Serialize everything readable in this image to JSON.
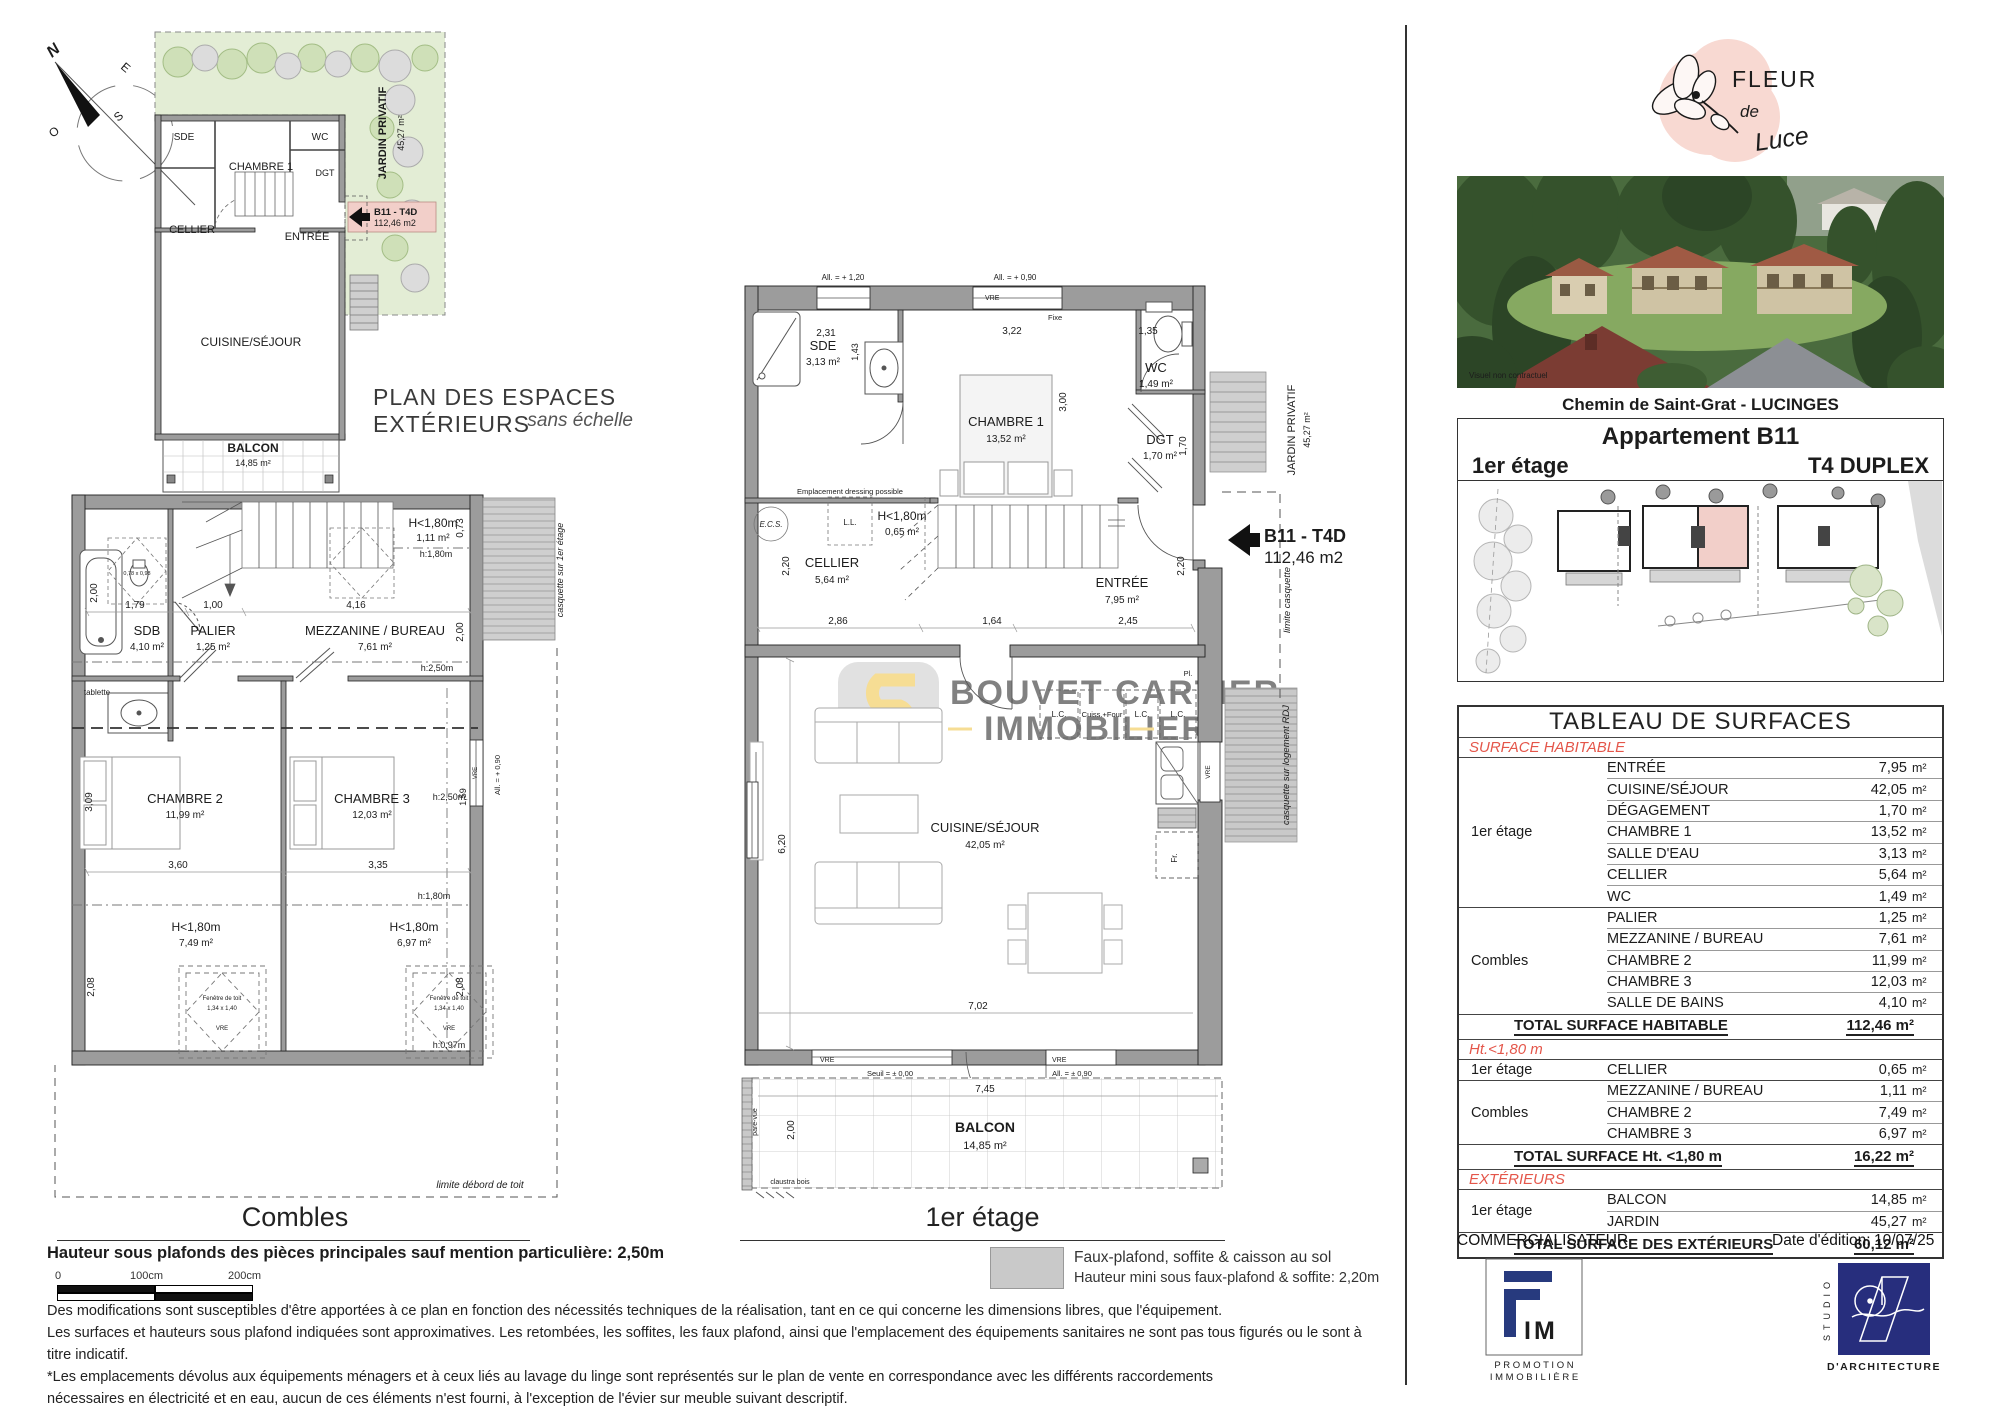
{
  "captions": {
    "mini_title": "PLAN DES ESPACES EXTÉRIEURS",
    "mini_sub": "sans échelle",
    "combles": "Combles",
    "etage": "1er étage"
  },
  "compass": {
    "n": "N",
    "e": "E",
    "s": "S",
    "o": "O"
  },
  "tag": {
    "name": "B11 - T4D",
    "area": "112,46 m2"
  },
  "mini": {
    "sde": "SDE",
    "ch1": "CHAMBRE 1",
    "wc": "WC",
    "dgt": "DGT",
    "cellier": "CELLIER",
    "entree": "ENTRÉE",
    "cuisine": "CUISINE/SÉJOUR",
    "balcon": "BALCON",
    "balcon_area": "14,85 m²",
    "jardin": "JARDIN PRIVATIF",
    "jardin_area": "45,27 m²"
  },
  "etage": {
    "rooms": {
      "sde": "SDE",
      "sde_a": "3,13 m²",
      "ch1": "CHAMBRE 1",
      "ch1_a": "13,52 m²",
      "wc": "WC",
      "wc_a": "1,49 m²",
      "dgt": "DGT",
      "dgt_a": "1,70 m²",
      "cellier": "CELLIER",
      "cellier_a": "5,64 m²",
      "entree": "ENTRÉE",
      "entree_a": "7,95 m²",
      "cuisine": "CUISINE/SÉJOUR",
      "cuisine_a": "42,05 m²",
      "balcon": "BALCON",
      "balcon_a": "14,85 m²"
    },
    "dims": [
      "2,31",
      "1,43",
      "3,22",
      "1,35",
      "3,00",
      "1,70",
      "2,20",
      "2,20",
      "2,86",
      "1,64",
      "2,45",
      "6,20",
      "7,02",
      "7,45",
      "2,00"
    ],
    "ann": {
      "a120": "All. = + 1,20",
      "a090": "All. = + 0,90",
      "vre": "VRE",
      "fixe": "Fixe",
      "dressing": "Emplacement dressing possible",
      "ecs": "E.C.S.",
      "ll": "L.L.",
      "h180": "H<1,80m",
      "h180a": "0,65 m²",
      "lc": "L.C.",
      "cuiss": "Cuiss.+Four",
      "fr": "Fr.",
      "pl": "Pl.",
      "seuil": "Seuil = ± 0,00",
      "a090b": "All. = ± 0,90",
      "pare": "pare-vue",
      "claustra": "claustra bois",
      "limcasq": "limite casquette",
      "casqrdj": "casquette sur logement RDJ",
      "jardin": "JARDIN PRIVATIF",
      "jardin_a": "45,27 m²",
      "a120r": "All. = + 1,20"
    }
  },
  "combles": {
    "rooms": {
      "sdb": "SDB",
      "sdb_a": "4,10 m²",
      "palier": "PALIER",
      "palier_a": "1,25 m²",
      "mezz": "MEZZANINE / BUREAU",
      "mezz_a": "7,61 m²",
      "ch2": "CHAMBRE 2",
      "ch2_a": "11,99 m²",
      "ch3": "CHAMBRE 3",
      "ch3_a": "12,03 m²",
      "h180": "H<1,80m",
      "h180a": "1,11 m²",
      "h180b": "7,49 m²",
      "h180c": "6,97 m²"
    },
    "dims": [
      "2,00",
      "1,79",
      "1,00",
      "4,16",
      "0,73",
      "2,00",
      "3,09",
      "1,59",
      "3,60",
      "3,35",
      "2,08",
      "2,08"
    ],
    "ann": {
      "h18": "h:1,80m",
      "h25": "h:2,50m",
      "h097": "h:0,97m",
      "tablette": "tablette",
      "casq": "casquette sur 1er étage",
      "fen": "Fenêtre de toit",
      "fs1": "0,78 x 0,98",
      "fs2": "1,34 x 1,40",
      "vre": "VRE",
      "a090": "All. = + 0,90",
      "limite": "limite débord de toit"
    }
  },
  "watermark": {
    "line1": "BOUVET CARTIER",
    "line2": "IMMOBILIER"
  },
  "right": {
    "logo": {
      "fleur": "FLEUR",
      "de": "de",
      "luce": "Luce"
    },
    "photo_note": "Visuel non contractuel",
    "address": "Chemin de Saint-Grat - LUCINGES",
    "apt": "Appartement B11",
    "floor": "1er étage",
    "type": "T4 DUPLEX"
  },
  "table": {
    "title": "TABLEAU DE SURFACES",
    "unit": "m²",
    "s1": {
      "header": "SURFACE HABITABLE",
      "g1": {
        "label": "1er étage",
        "rows": [
          {
            "n": "ENTRÉE",
            "v": "7,95"
          },
          {
            "n": "CUISINE/SÉJOUR",
            "v": "42,05"
          },
          {
            "n": "DÉGAGEMENT",
            "v": "1,70"
          },
          {
            "n": "CHAMBRE 1",
            "v": "13,52"
          },
          {
            "n": "SALLE D'EAU",
            "v": "3,13"
          },
          {
            "n": "CELLIER",
            "v": "5,64"
          },
          {
            "n": "WC",
            "v": "1,49"
          }
        ]
      },
      "g2": {
        "label": "Combles",
        "rows": [
          {
            "n": "PALIER",
            "v": "1,25"
          },
          {
            "n": "MEZZANINE / BUREAU",
            "v": "7,61"
          },
          {
            "n": "CHAMBRE 2",
            "v": "11,99"
          },
          {
            "n": "CHAMBRE 3",
            "v": "12,03"
          },
          {
            "n": "SALLE DE BAINS",
            "v": "4,10"
          }
        ]
      },
      "total": {
        "label": "TOTAL SURFACE HABITABLE",
        "value": "112,46 m²"
      }
    },
    "s2": {
      "header": "Ht.<1,80 m",
      "g1": {
        "label": "1er étage",
        "rows": [
          {
            "n": "CELLIER",
            "v": "0,65"
          }
        ]
      },
      "g2": {
        "label": "Combles",
        "rows": [
          {
            "n": "MEZZANINE / BUREAU",
            "v": "1,11"
          },
          {
            "n": "CHAMBRE 2",
            "v": "7,49"
          },
          {
            "n": "CHAMBRE 3",
            "v": "6,97"
          }
        ]
      },
      "total": {
        "label": "TOTAL SURFACE Ht. <1,80 m",
        "value": "16,22 m²"
      }
    },
    "s3": {
      "header": "EXTÉRIEURS",
      "g1": {
        "label": "1er étage",
        "rows": [
          {
            "n": "BALCON",
            "v": "14,85"
          },
          {
            "n": "JARDIN",
            "v": "45,27"
          }
        ]
      },
      "total": {
        "label": "TOTAL SURFACE  DES EXTÉRIEURS",
        "value": "60,12 m²"
      }
    }
  },
  "footer": {
    "left": "COMMERCIALISATEUR",
    "date_label": "Date d'édition:",
    "date": "10/07/25",
    "fim": {
      "im": "IM",
      "l1": "P R O M O T I O N",
      "l2": "I M M O B I L I È R E"
    },
    "studio": {
      "vert": "STUDIO",
      "sub": "D'ARCHITECTURE"
    }
  },
  "notes": {
    "bold": "Hauteur sous plafonds des pièces principales sauf mention particulière: 2,50m",
    "p1": "Des modifications sont susceptibles d'être apportées à ce plan en fonction des nécessités techniques de la réalisation, tant en ce qui concerne les dimensions libres, que l'équipement.",
    "p2": "Les surfaces et hauteurs sous plafond indiquées sont approximatives. Les retombées, les soffites, les faux plafond, ainsi que l'emplacement des équipements sanitaires ne sont pas tous figurés ou le sont à titre indicatif.",
    "p3": "*Les emplacements dévolus aux équipements ménagers et à ceux liés au lavage du linge sont représentés sur le plan de vente en correspondance avec les différents raccordements",
    "p4": "nécessaires en électricité et en eau, aucun de ces éléments n'est fourni, à l'exception de l'évier sur meuble suivant descriptif."
  },
  "legend": {
    "l1": "Faux-plafond, soffite & caisson au sol",
    "l2": "Hauteur mini sous faux-plafond & soffite: 2,20m"
  },
  "scale": {
    "z": "0",
    "one": "100cm",
    "two": "200cm"
  },
  "colors": {
    "red": "#e4564a",
    "wall": "#9c9c9c",
    "pink": "#f2cfc9",
    "navy": "#273a7e",
    "green": "#e3edd5"
  }
}
